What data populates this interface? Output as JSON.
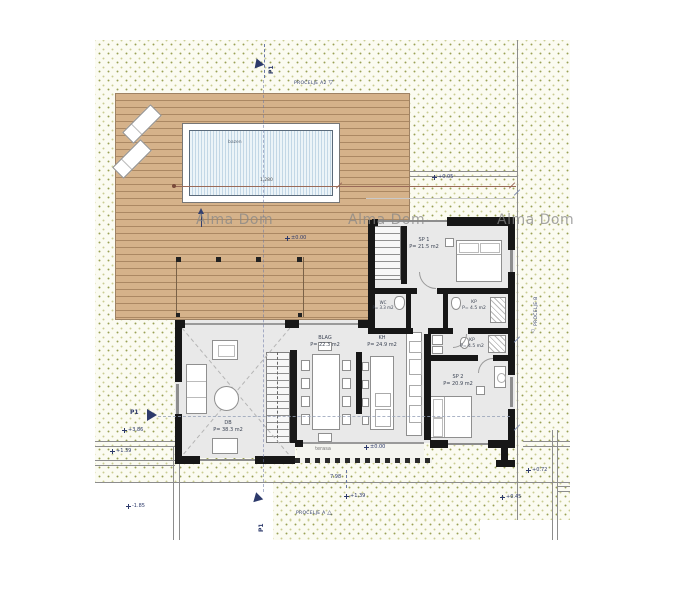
{
  "watermarks": [
    "Alma Dom",
    "Alma Dom",
    "Alma Dom"
  ],
  "pool": {
    "label": "bazen",
    "dim_label": "1.280"
  },
  "rooms": {
    "sp1": {
      "name": "SP 1",
      "area": "P= 21.5 m2"
    },
    "kp1": {
      "name": "KP",
      "area": "P= 4.5 m2"
    },
    "kp2": {
      "name": "KP",
      "area": "P= 4.5 m2"
    },
    "wc": {
      "name": "WC",
      "area": "P= 3.3 m2"
    },
    "blag": {
      "name": "BLAG",
      "area": "P= 22.3 m2"
    },
    "kh": {
      "name": "KH",
      "area": "P= 24.9 m2"
    },
    "db": {
      "name": "DB",
      "area": "P= 38.3 m2"
    },
    "sp2": {
      "name": "SP 2",
      "area": "P= 20.9 m2"
    },
    "terasa": {
      "name": "terasa"
    }
  },
  "sections": {
    "p1_top": "P1",
    "p1_left": "P1",
    "p1_bottom": "P1"
  },
  "facades": {
    "top": "PROČELJE A2",
    "right": "PROČELJE B",
    "bottom": "PROČELJE A"
  },
  "levels": {
    "deck": "±0.00",
    "terrace": "±0.00",
    "left_upper": "+3.86",
    "left_mid": "+1.39",
    "left_lower": "-1.85",
    "bottom_center": "+1.39",
    "right_upper": "+0.72",
    "right_lower": "+0.45",
    "top_right": "+0.05"
  },
  "dims": {
    "bottom": "7.98"
  },
  "icons": {
    "triangle_down": "▽",
    "triangle_up": "△"
  },
  "colors": {
    "wall": "#171717",
    "deck": "#d5b28a",
    "pool_water": "#d6e6f0",
    "site_dot": "#9aa055",
    "annotation": "#2d3a6b"
  }
}
